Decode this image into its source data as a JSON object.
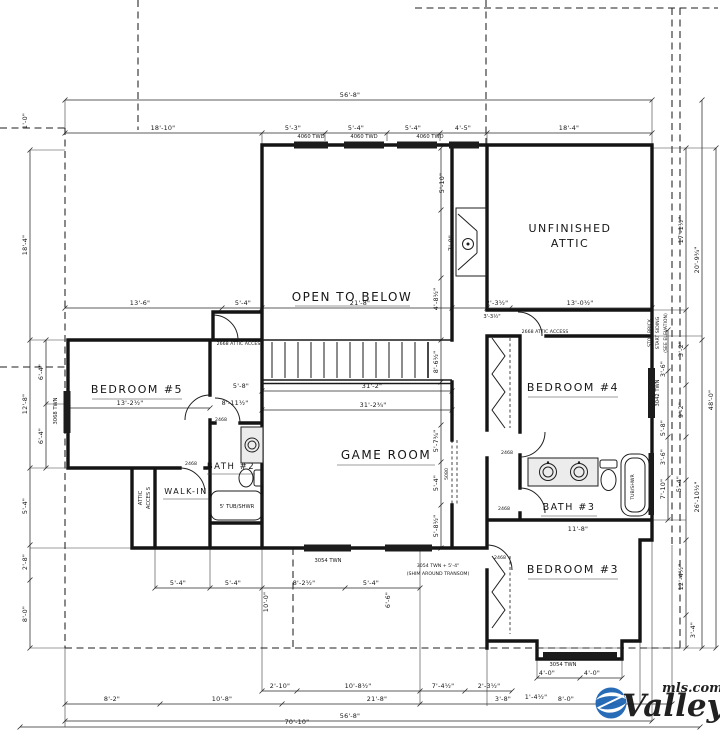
{
  "drawing": {
    "rooms": {
      "open_to_below": "OPEN TO BELOW",
      "unfinished_attic_1": "UNFINISHED",
      "unfinished_attic_2": "ATTIC",
      "bedroom5": "BEDROOM #5",
      "bedroom4": "BEDROOM #4",
      "bedroom3": "BEDROOM #3",
      "game_room": "GAME ROOM",
      "bath2": "BATH #2",
      "bath3": "BATH #3",
      "walk_in": "WALK-IN",
      "attic_access_1": "ATTIC",
      "attic_access_2": "ACCES S"
    },
    "notes": {
      "attic_access_left": "2668 ATTIC ACCESS",
      "attic_access_right": "2668 ATTIC ACCESS",
      "siding_1": "STOP BRICK",
      "siding_2": "START SIDING",
      "siding_3": "(SEE ELEVATION)",
      "tub5": "5' TUB/SHWR",
      "tub_shwr": "TUB/SHWR",
      "transom_1": "3054 TWN + 5'-4\"",
      "transom_2": "(SHIM AROUND TRANSOM)"
    },
    "windows": [
      "4060 TWD",
      "4060 TWD",
      "4060 TWD",
      "3068 TWN",
      "3042 TWN",
      "3054 TWN",
      "3054 TWN"
    ],
    "doors": [
      "2468",
      "2468",
      "2468",
      "2468",
      "2468",
      "5080"
    ],
    "dims": {
      "top": [
        "56'-8\"",
        "18'-10\"",
        "5'-3\"",
        "5'-4\"",
        "5'-4\"",
        "4'-5\"",
        "18'-4\""
      ],
      "left": [
        "1'-0\"",
        "18'-4\"",
        "6'-4\"",
        "12'-8\"",
        "6'-4\"",
        "5'-4\"",
        "2'-8\"",
        "8'-0\""
      ],
      "right": [
        "17'-1½\"",
        "20'-9¾\"",
        "48'-0\"",
        "3'-2\"",
        "3'-6\"",
        "9'-2\"",
        "5'-8\"",
        "3'-6\"",
        "7'-10\"",
        "5'-4\"",
        "26'-10½\"",
        "12'-4½\"",
        "3'-4\""
      ],
      "bottom": [
        "8'-2\"",
        "10'-8\"",
        "2'-10\"",
        "10'-8½\"",
        "21'-8\"",
        "7'-4½\"",
        "2'-3½\"",
        "3'-8\"",
        "1'-4½\"",
        "8'-0\"",
        "4'-0\"",
        "4'-0\"",
        "56'-8\"",
        "70'-10\""
      ],
      "interior": [
        "13'-6\"",
        "5'-4\"",
        "21'-8\"",
        "2'-3½\"",
        "13'-0½\"",
        "3'-3½\"",
        "5'-10\"",
        "7'-0\"",
        "4'-8½\"",
        "31'-2\"",
        "31'-2¾\"",
        "5'-8\"",
        "8'-11½\"",
        "13'-2½\"",
        "8'-6½\"",
        "5'-7¾\"",
        "5'-4\"",
        "5'-8½\"",
        "11'-8\"",
        "10'-0\"",
        "6'-6\"",
        "5'-4\"",
        "5'-4\"",
        "8'-2½\"",
        "5'-4\""
      ]
    }
  },
  "watermark": {
    "brand": "Valley",
    "suffix": "mls.com",
    "color": "#1d64b4"
  }
}
